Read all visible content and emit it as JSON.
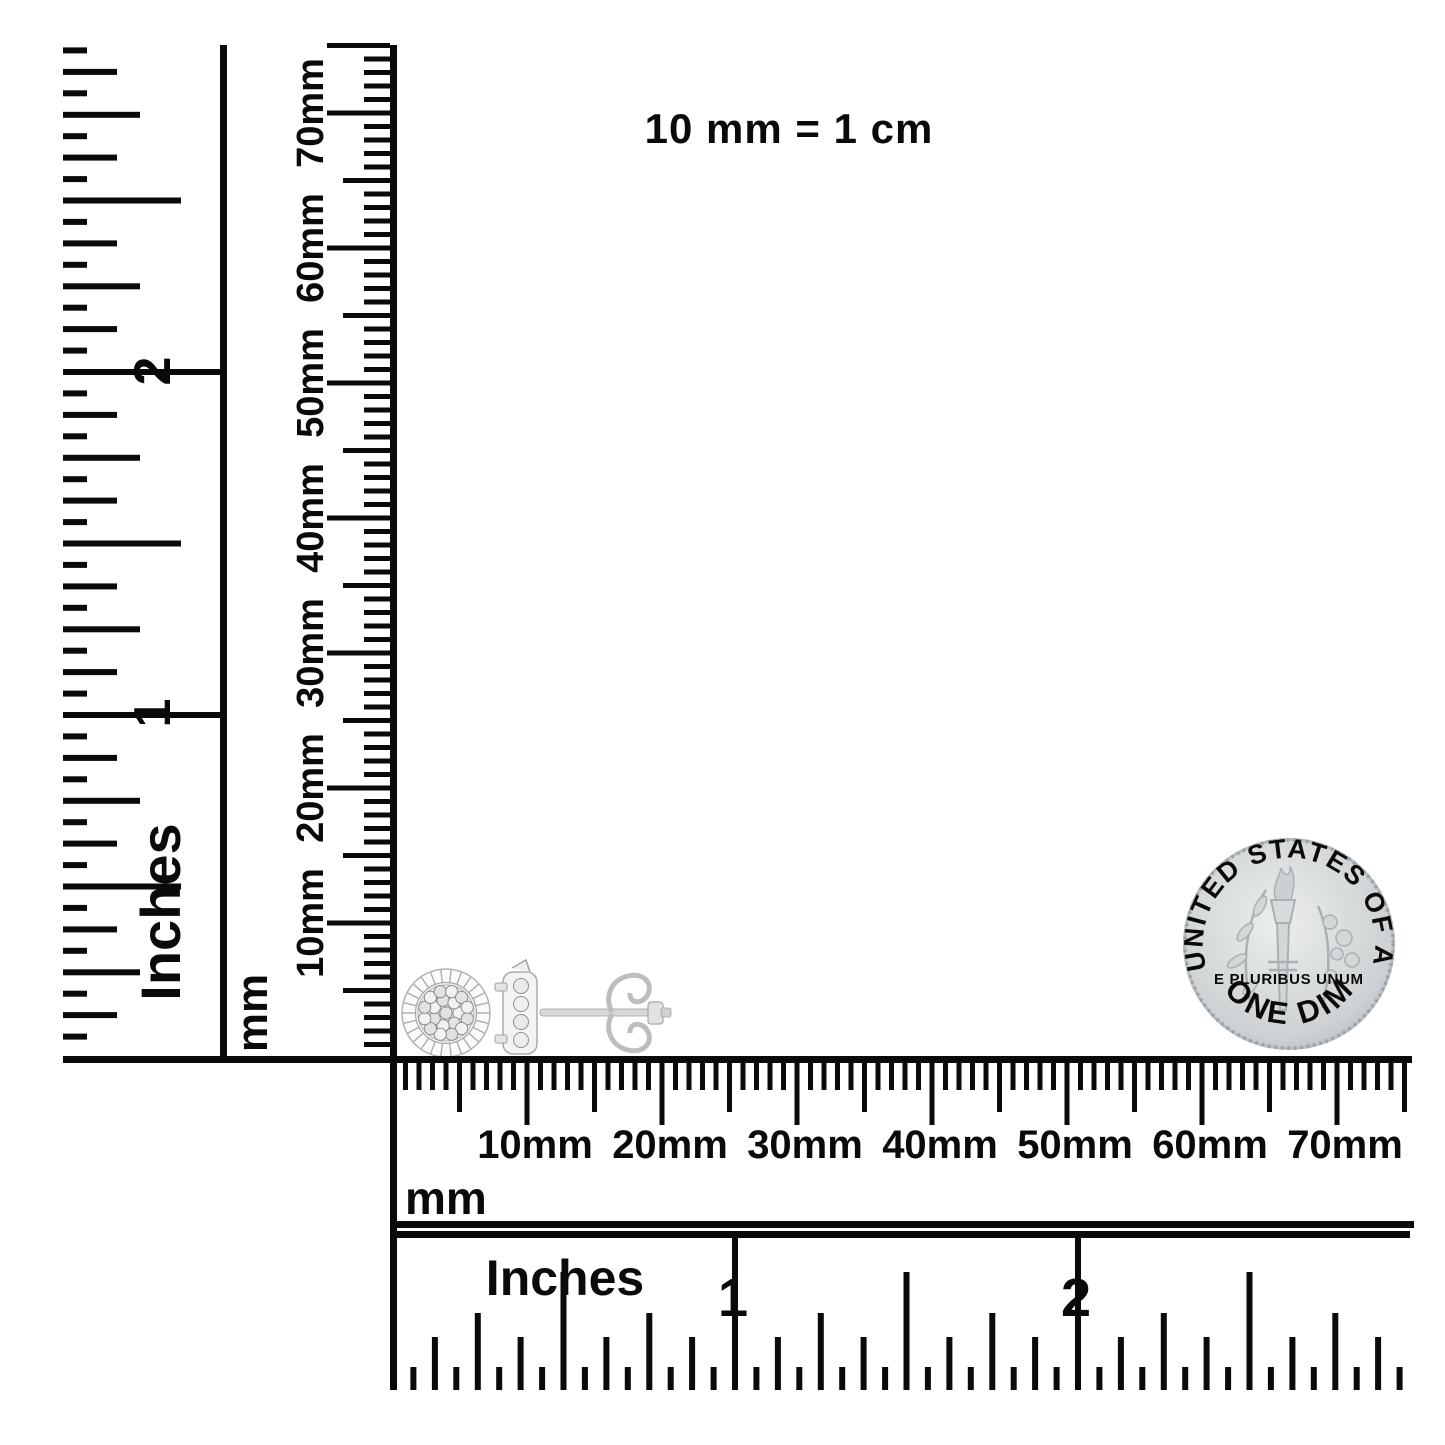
{
  "scale_note": {
    "text": "10 mm = 1 cm"
  },
  "rulers": {
    "left_inches": {
      "unit_label": "Inches",
      "inch_labels": [
        "1",
        "2"
      ]
    },
    "vertical_mm": {
      "unit_label": "mm",
      "tick_labels": [
        "10mm",
        "20mm",
        "30mm",
        "40mm",
        "50mm",
        "60mm",
        "70mm"
      ]
    },
    "horizontal_mm": {
      "unit_label": "mm",
      "tick_labels": [
        "10mm",
        "20mm",
        "30mm",
        "40mm",
        "50mm",
        "60mm",
        "70mm"
      ]
    },
    "bottom_inches": {
      "unit_label": "Inches",
      "inch_labels": [
        "1",
        "2"
      ]
    }
  },
  "coin": {
    "top_text": "UNITED STATES OF AMERICA",
    "middle_text": "E PLURIBUS UNUM",
    "bottom_text": "ONE DIME"
  },
  "objects": {
    "earrings": "diamond cluster stud earrings (front view and side view with post and butterfly back)",
    "coin": "US dime reverse"
  },
  "colors": {
    "ink": "#0a0a0a",
    "background": "#ffffff",
    "coin_silver": "#cfd3d5",
    "earring_silver": "#e9e9e9"
  }
}
